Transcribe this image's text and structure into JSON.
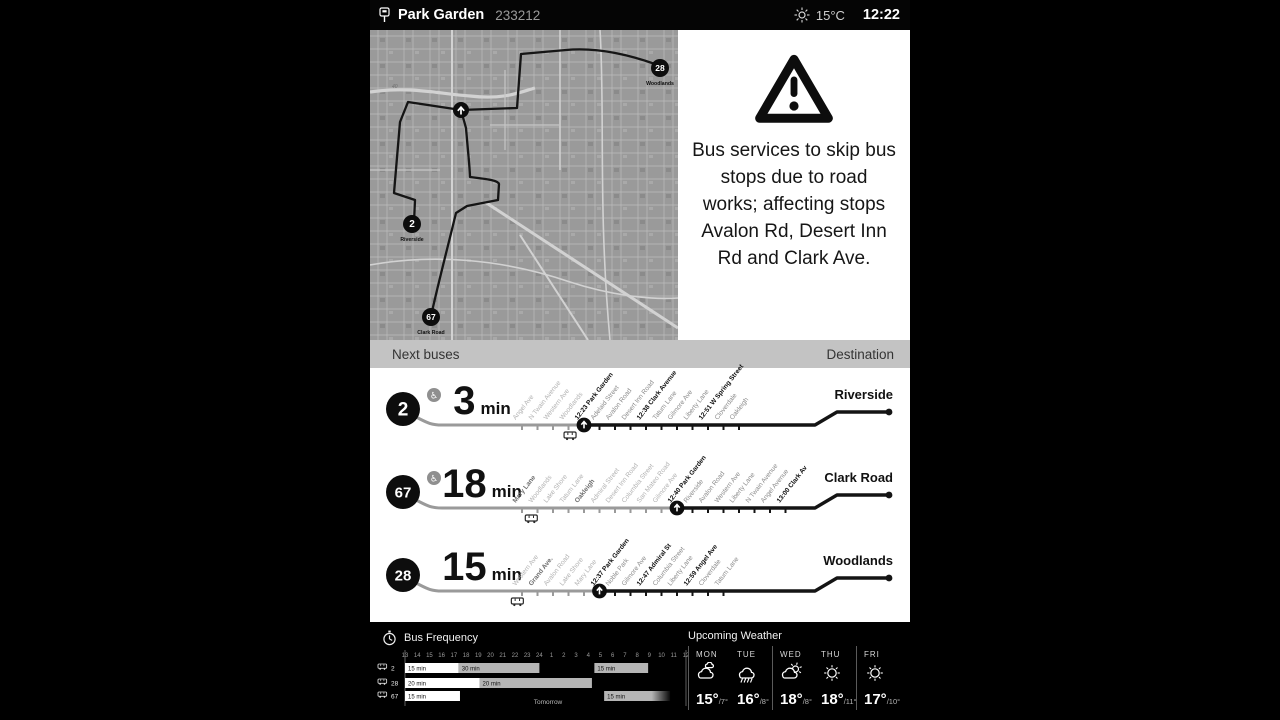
{
  "header": {
    "stop_name": "Park Garden",
    "stop_id": "233212",
    "temperature": "15°C",
    "time": "12:22"
  },
  "alert": {
    "text": "Bus services to skip bus stops due to road works; affecting stops Avalon Rd, Desert Inn Rd and Clark Ave."
  },
  "map": {
    "road_label": "40",
    "markers": [
      {
        "route": "28",
        "label": "Woodlands"
      },
      {
        "route": "2",
        "label": "Riverside"
      },
      {
        "route": "67",
        "label": "Clark Road"
      }
    ]
  },
  "next_buses": {
    "title": "Next buses",
    "destination_header": "Destination",
    "rows": [
      {
        "route": "2",
        "accessible": true,
        "minutes": "3",
        "unit": "min",
        "destination": "Riverside",
        "bus_index": 3.1,
        "stops": [
          {
            "name": "Angel Ave",
            "past": true
          },
          {
            "name": "N Twain Avenue",
            "past": true
          },
          {
            "name": "Western Ave",
            "past": true
          },
          {
            "name": "Woodlands",
            "past": true
          },
          {
            "name": "12:23 Park Garden",
            "bold": true,
            "marker": true
          },
          {
            "name": "Adelaid Street"
          },
          {
            "name": "Avalon Road"
          },
          {
            "name": "Desert Inn Road"
          },
          {
            "name": "12:38 Clark Avenue",
            "bold": true
          },
          {
            "name": "Tatum Lane"
          },
          {
            "name": "Gilmore Ave"
          },
          {
            "name": "Liberty Lane"
          },
          {
            "name": "12:51 W Spring Street",
            "bold": true
          },
          {
            "name": "Cloverdale"
          },
          {
            "name": "Oakleigh"
          }
        ]
      },
      {
        "route": "67",
        "accessible": true,
        "minutes": "18",
        "unit": "min",
        "destination": "Clark Road",
        "bus_index": 0.6,
        "stops": [
          {
            "name": "Mary Lane",
            "past": true,
            "bold": true
          },
          {
            "name": "Woodlands",
            "past": true
          },
          {
            "name": "Lake Shore",
            "past": true
          },
          {
            "name": "Tatum Lane",
            "past": true
          },
          {
            "name": "Oakleigh",
            "past": true,
            "bold": true
          },
          {
            "name": "Admiral Street",
            "past": true
          },
          {
            "name": "Desert Inn Road",
            "past": true
          },
          {
            "name": "Columbia Street",
            "past": true
          },
          {
            "name": "San Mateo Road",
            "past": true
          },
          {
            "name": "Gilmore Ave",
            "past": true
          },
          {
            "name": "12:40 Park Garden",
            "bold": true,
            "marker": true
          },
          {
            "name": "Riverside"
          },
          {
            "name": "Avalon Road"
          },
          {
            "name": "Western Ave"
          },
          {
            "name": "Liberty Lane"
          },
          {
            "name": "N Twain Avenue"
          },
          {
            "name": "Angel Avenue"
          },
          {
            "name": "13:00 Clark Av",
            "bold": true
          }
        ]
      },
      {
        "route": "28",
        "accessible": false,
        "minutes": "15",
        "unit": "min",
        "destination": "Woodlands",
        "bus_index": -0.3,
        "stops": [
          {
            "name": "Western Ave",
            "past": true
          },
          {
            "name": "Grand Ave.",
            "past": true,
            "bold": true
          },
          {
            "name": "Avalon Road",
            "past": true
          },
          {
            "name": "Lake Shore",
            "past": true
          },
          {
            "name": "Mary Lane",
            "past": true
          },
          {
            "name": "12:37 Park Garden",
            "bold": true,
            "marker": true
          },
          {
            "name": "Noble Park"
          },
          {
            "name": "Gilmore Ave"
          },
          {
            "name": "12:47 Admiral St",
            "bold": true
          },
          {
            "name": "Columbia Street"
          },
          {
            "name": "Liberty Lane"
          },
          {
            "name": "12:59 Angel Ave",
            "bold": true
          },
          {
            "name": "Cloverdale"
          },
          {
            "name": "Tatum Lane"
          }
        ]
      }
    ]
  },
  "frequency": {
    "title": "Bus Frequency",
    "hours": [
      "13",
      "14",
      "15",
      "16",
      "17",
      "18",
      "19",
      "20",
      "21",
      "22",
      "23",
      "24",
      "1",
      "2",
      "3",
      "4",
      "5",
      "6",
      "7",
      "8",
      "9",
      "10",
      "11",
      "12"
    ],
    "tomorrow_label": "Tomorrow",
    "rows": [
      {
        "route": "2",
        "bars": [
          {
            "label": "15 min",
            "start": 0,
            "end": 4.4,
            "style": "white"
          },
          {
            "label": "30 min",
            "start": 4.4,
            "end": 11,
            "style": "gray"
          },
          {
            "label": "15 min",
            "start": 15.5,
            "end": 19.9,
            "style": "gray"
          }
        ]
      },
      {
        "route": "28",
        "bars": [
          {
            "label": "20 min",
            "start": 0,
            "end": 6.1,
            "style": "white"
          },
          {
            "label": "20 min",
            "start": 6.1,
            "end": 15.3,
            "style": "gray"
          }
        ]
      },
      {
        "route": "67",
        "bars": [
          {
            "label": "15 min",
            "start": 0,
            "end": 4.5,
            "style": "white"
          },
          {
            "label": "15 min",
            "start": 16.3,
            "end": 21.7,
            "style": "gray",
            "fade": true
          }
        ]
      }
    ]
  },
  "weather": {
    "title": "Upcoming Weather",
    "days": [
      {
        "name": "MON",
        "icon": "clouds",
        "high": "15°",
        "low": "/7°"
      },
      {
        "name": "TUE",
        "icon": "rain",
        "high": "16°",
        "low": "/8°"
      },
      {
        "name": "WED",
        "icon": "partly-sunny",
        "high": "18°",
        "low": "/8°"
      },
      {
        "name": "THU",
        "icon": "sunny",
        "high": "18°",
        "low": "/11°"
      },
      {
        "name": "FRI",
        "icon": "sunny",
        "high": "17°",
        "low": "/10°"
      }
    ]
  }
}
